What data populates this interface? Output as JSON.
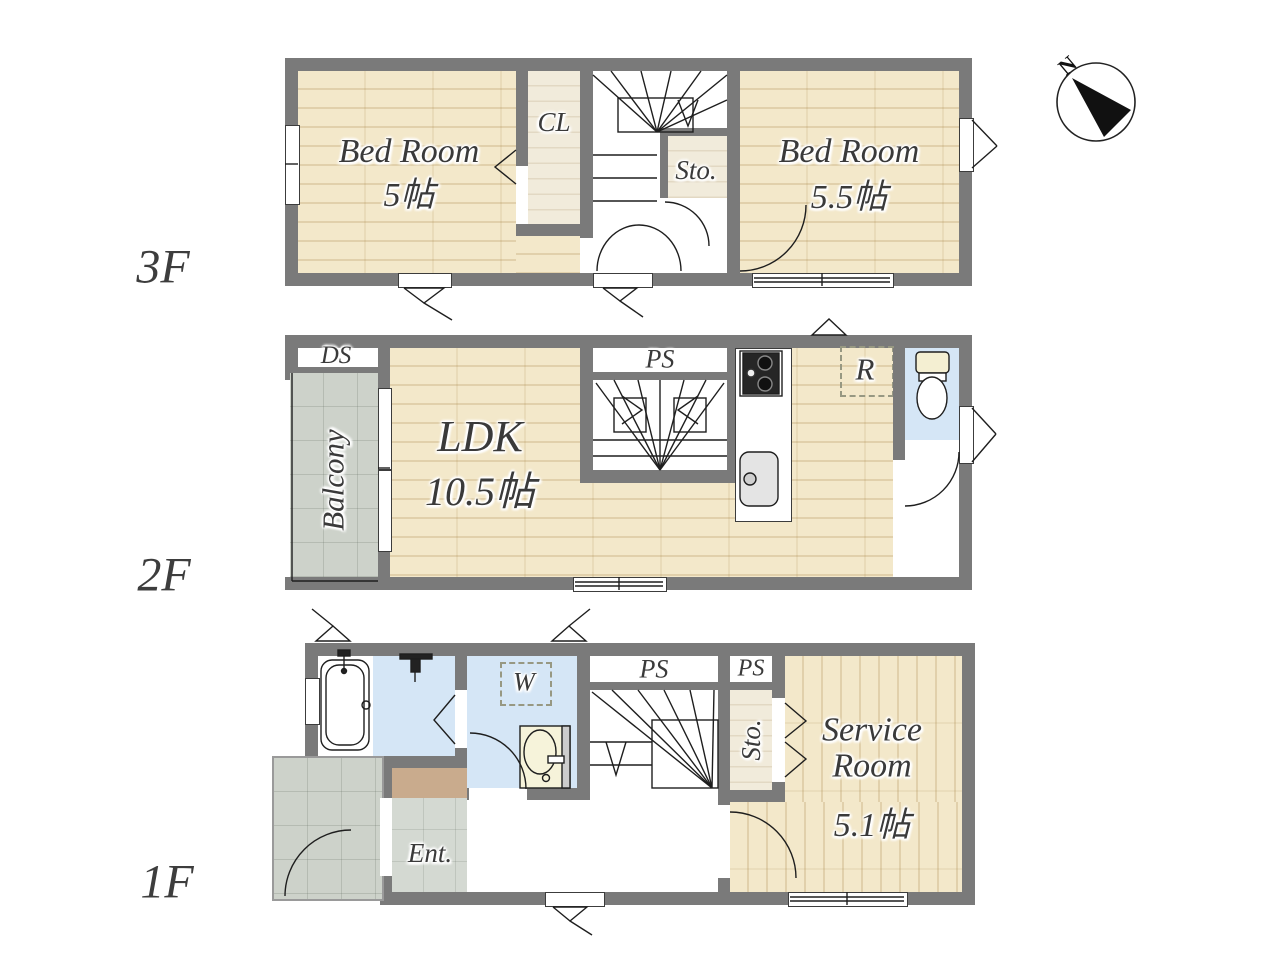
{
  "compass": {
    "north": "N"
  },
  "colors": {
    "wall": "#7a7a7a",
    "wood_floor": "#f3e8ca",
    "light_wood_floor": "#f1ebdb",
    "balcony_tile": "#cdd2ca",
    "entrance_tile": "#d4d9d2",
    "wet_area_blue": "#d5e6f6",
    "entrance_step_tan": "#c9ab8d",
    "label_text": "#3a3a3a"
  },
  "floors": {
    "f3": {
      "label": "3F",
      "bedroom1": {
        "name": "Bed Room",
        "size": "5帖"
      },
      "closet": "CL",
      "storage": "Sto.",
      "bedroom2": {
        "name": "Bed Room",
        "size": "5.5帖"
      }
    },
    "f2": {
      "label": "2F",
      "duct_space": "DS",
      "balcony": "Balcony",
      "ldk": {
        "name": "LDK",
        "size": "10.5帖"
      },
      "pipe_space": "PS",
      "refrigerator": "R"
    },
    "f1": {
      "label": "1F",
      "pipe_space1": "PS",
      "pipe_space2": "PS",
      "washer": "W",
      "storage": "Sto.",
      "service_room": {
        "name": "Service Room",
        "size": "5.1帖"
      },
      "entrance": "Ent."
    }
  }
}
